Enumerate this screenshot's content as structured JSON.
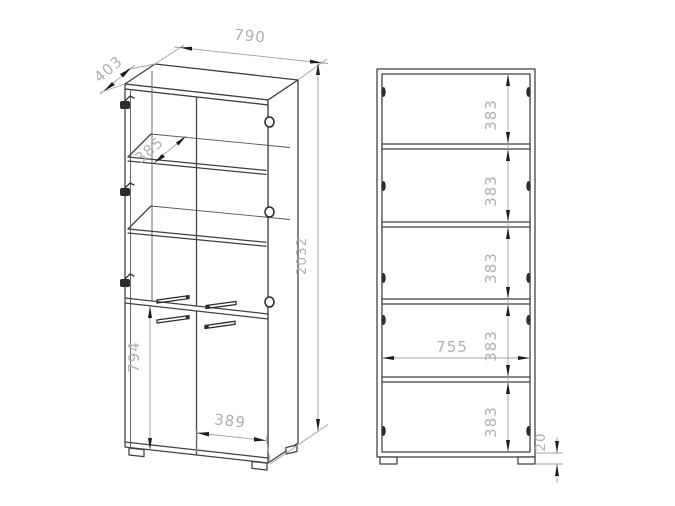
{
  "drawing": {
    "title": "Display cabinet technical drawing, two views with dimensions (mm)",
    "views": {
      "left": "front perspective view",
      "right": "front elevation / section view"
    },
    "dimensions": {
      "left": {
        "depth": "403",
        "width": "790",
        "height": "2032",
        "shelf_depth": "385",
        "door_height": "794",
        "door_width": "389"
      },
      "right": {
        "spacings": [
          "383",
          "383",
          "383",
          "383",
          "383"
        ],
        "inner_width": "755",
        "foot_height": "20"
      }
    },
    "colors": {
      "object_line": "#3f3f3f",
      "dimension_line": "#a2a2a2",
      "dimension_text": "#b0b0b0",
      "arrow": "#1d1d1d",
      "background": "#ffffff"
    }
  }
}
